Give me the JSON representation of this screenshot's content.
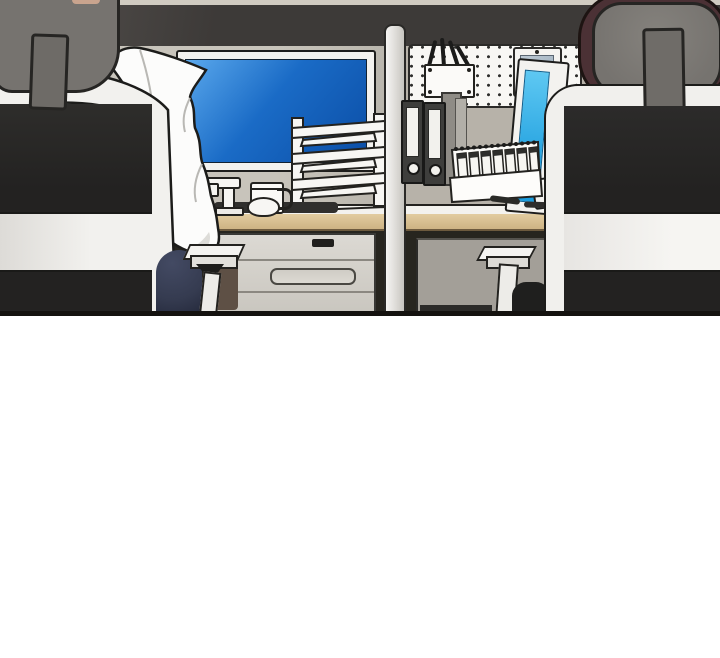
{
  "meta": {
    "kind": "webtoon-comic-panel",
    "description": "Empty office scene: two cubicle workstations seen from behind, separated by a divider pole; left desk has a monitor with blue screen, a white coat draped over a black office chair, paper trays, mug, lamp and drawer unit; right desk has a pegboard with pen basket and wall tablet, binders, a flip desk calendar and a monitor with cyan screen behind a second black office chair."
  },
  "colors": {
    "strip": "#d0cbc1",
    "band": "#3d3a38",
    "band-hi": "#56524f",
    "wall-left": "#c8c4bb",
    "wall-right": "#b7b2a9",
    "bezel": "#f3f2ef",
    "screen-blue": "#1a6bc6",
    "screen-blue-hi": "#5aa8ec",
    "screen-cyan": "#1b9cdd",
    "screen-cyan-hi": "#5ec8f2",
    "pegboard": "#f8f7f4",
    "tablet-screen": "#a2b3c1",
    "binder": "#3e3e3c",
    "headrest": "#76736f",
    "maroon": "#4b3135",
    "navy": "#353b50",
    "floor-brown": "#5e5045",
    "mat": "#302f2d",
    "desk-wood": "#d9c49c",
    "coat": "#fcfcfb",
    "chair-black": "#262524",
    "chair-band": "#eceae7"
  },
  "scene": {
    "panel": {
      "width": 720,
      "height": 316,
      "bottom_border": "#14120f"
    },
    "left_cubicle": {
      "objects": [
        "office-chair-left",
        "chair-headrest",
        "white-coat",
        "monitor-blue-screen",
        "desk",
        "drawer-unit",
        "paper-tray-organizer",
        "desk-lamp",
        "mug",
        "mouse",
        "desk-mat",
        "armrest",
        "navy-bag",
        "floor-patch"
      ]
    },
    "divider": {
      "objects": [
        "divider-pole"
      ]
    },
    "right_cubicle": {
      "objects": [
        "office-chair-right",
        "chair-headrest",
        "maroon-cushion",
        "pegboard",
        "pen-basket",
        "pens",
        "wall-tablet",
        "binders",
        "binder-rack",
        "desk-flip-calendar",
        "pen",
        "desk",
        "modesty-panel",
        "armrest",
        "chair-seat",
        "monitor-cyan-screen",
        "monitor-stand"
      ]
    }
  }
}
